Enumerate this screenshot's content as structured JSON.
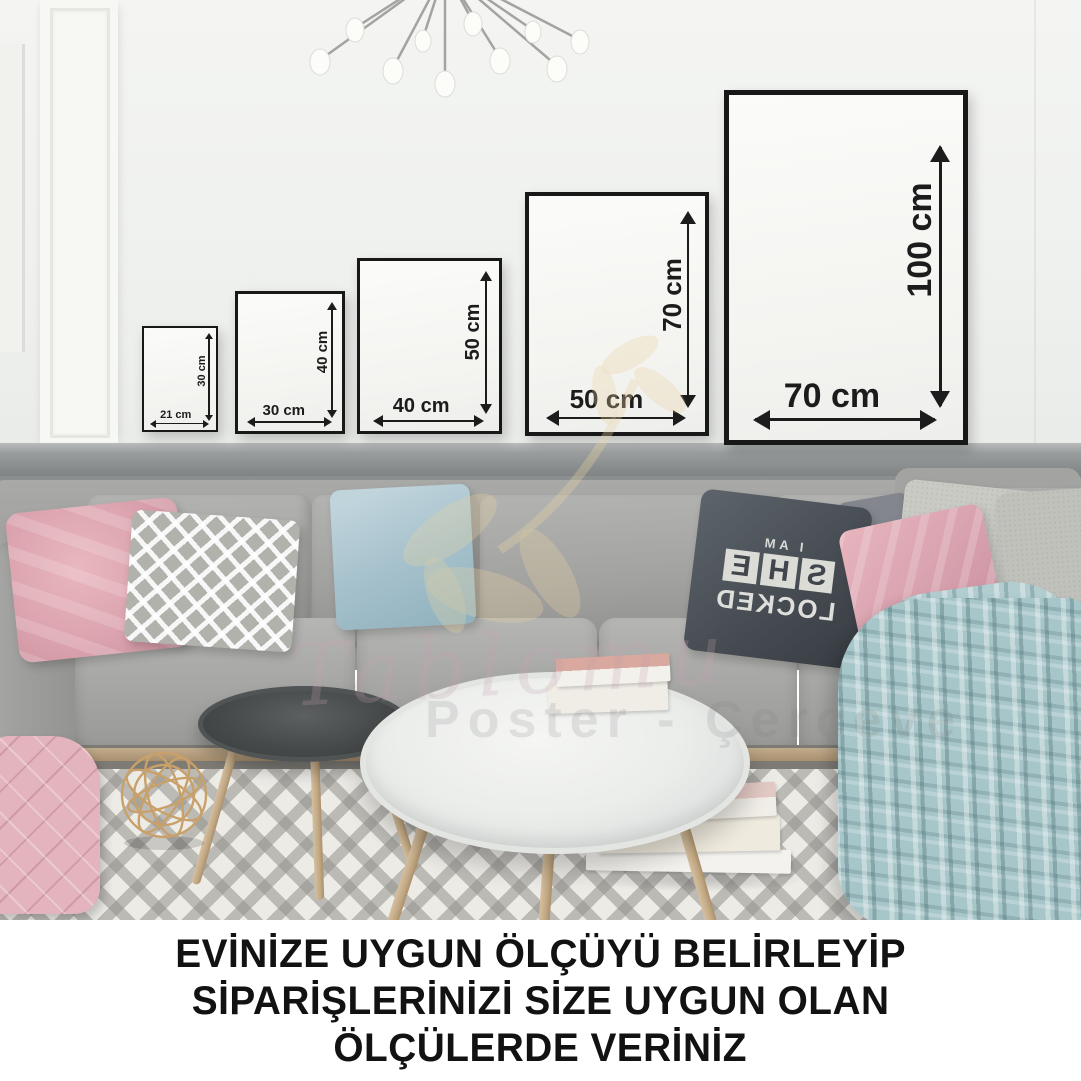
{
  "frames": [
    {
      "width_label": "21 cm",
      "height_label": "30 cm"
    },
    {
      "width_label": "30 cm",
      "height_label": "40 cm"
    },
    {
      "width_label": "40 cm",
      "height_label": "50 cm"
    },
    {
      "width_label": "50 cm",
      "height_label": "70 cm"
    },
    {
      "width_label": "70 cm",
      "height_label": "100 cm"
    }
  ],
  "pillow": {
    "line1": "I AM",
    "tiles": "SHE",
    "line2": "LOCKED"
  },
  "watermark": {
    "script": "Tablomu",
    "tagline": "Poster - Çerçeve"
  },
  "footer": {
    "line1": "EVİNİZE UYGUN ÖLÇÜYÜ BELİRLEYİP",
    "line2": "SİPARİŞLERİNİZİ SİZE UYGUN OLAN",
    "line3": "ÖLÇÜLERDE VERİNİZ"
  },
  "colors": {
    "frame_border": "#181818",
    "dimension_text": "#1c1c1c",
    "footer_text": "#121212",
    "sofa_gray": "#9d9d9b",
    "pink_pillow": "#dfa7b1",
    "blue_pillow": "#aec8d2",
    "blanket_teal": "#a7c6c9",
    "rug_base": "#edebe6"
  }
}
